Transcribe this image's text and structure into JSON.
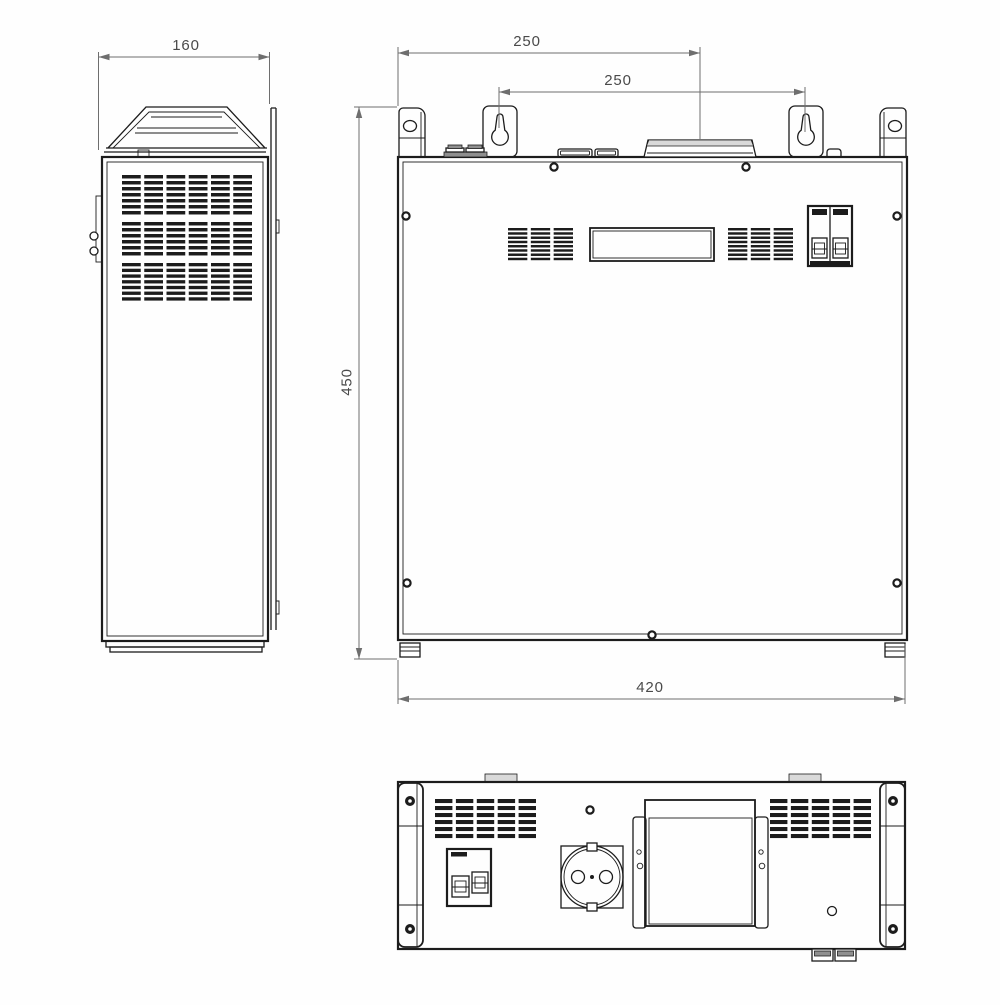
{
  "drawing": {
    "dimensions": {
      "side_depth": "160",
      "top_offset": "250",
      "mount_spacing": "250",
      "height": "450",
      "width": "420"
    },
    "colors": {
      "line": "#1c1c1c",
      "dim": "#6e6e6e",
      "text": "#4a4a4a",
      "bg": "#fefefe",
      "shade": "#d9d9d9",
      "mid": "#8f8f8f"
    }
  }
}
